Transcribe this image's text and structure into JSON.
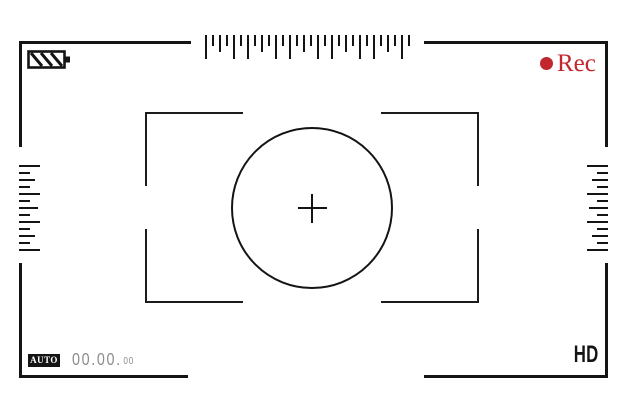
{
  "app": {
    "name": "camera-viewfinder"
  },
  "colors": {
    "frame": "#141414",
    "accent_red": "#c1272d",
    "timecode_gray": "#8c8c8c",
    "background": "#ffffff"
  },
  "status_bar": {
    "battery_icon": "battery-level-diagonal-stripes",
    "rec_indicator": {
      "dot": "record-dot",
      "label": "Rec"
    }
  },
  "bottom_bar": {
    "mode_badge": "AUTO",
    "timecode": {
      "main": "00.00.",
      "seconds": "00"
    },
    "quality_label": "HD"
  },
  "focus": {
    "crosshair_symbol": "+",
    "shape": "circle-with-corner-brackets"
  },
  "rulers": {
    "top": {
      "tick_sizes": [
        24,
        11,
        17,
        11,
        24,
        11,
        24,
        11,
        17,
        11,
        24,
        11,
        24,
        11,
        17,
        11,
        24,
        11,
        24,
        11,
        17,
        11,
        24,
        11,
        24,
        11,
        17,
        11,
        24,
        11
      ]
    },
    "left": {
      "tick_sizes": [
        21,
        11,
        16,
        11,
        21,
        11,
        19,
        11,
        21,
        11,
        16,
        11,
        21
      ]
    },
    "right": {
      "tick_sizes": [
        21,
        11,
        16,
        11,
        21,
        11,
        19,
        11,
        21,
        11,
        16,
        11,
        21
      ]
    }
  }
}
